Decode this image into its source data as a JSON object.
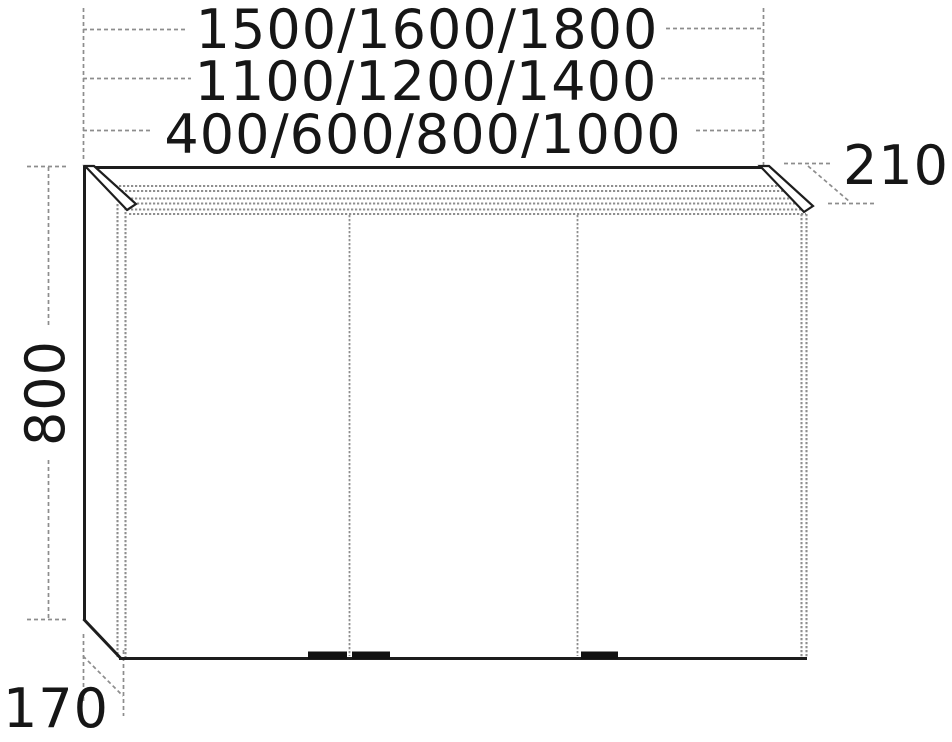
{
  "figure": {
    "type": "technical-dimension-drawing",
    "subject": "mirror cabinet with light cornice, three doors, front elevation with size options (mm)"
  },
  "labels": {
    "width_row_top": "1500/1600/1800",
    "width_row_middle": "1100/1200/1400",
    "width_row_bottom": "400/600/800/1000",
    "cornice_depth": "210",
    "height": "800",
    "body_depth": "170"
  },
  "cabinet": {
    "door_count": 3,
    "handle_count": 3
  },
  "colors": {
    "outline": "#1d1d1d",
    "panel_gray": "#8f8f8f",
    "dimension_gray": "#8d8d8d",
    "text": "#161616",
    "handle": "#111111",
    "background": "#ffffff"
  }
}
